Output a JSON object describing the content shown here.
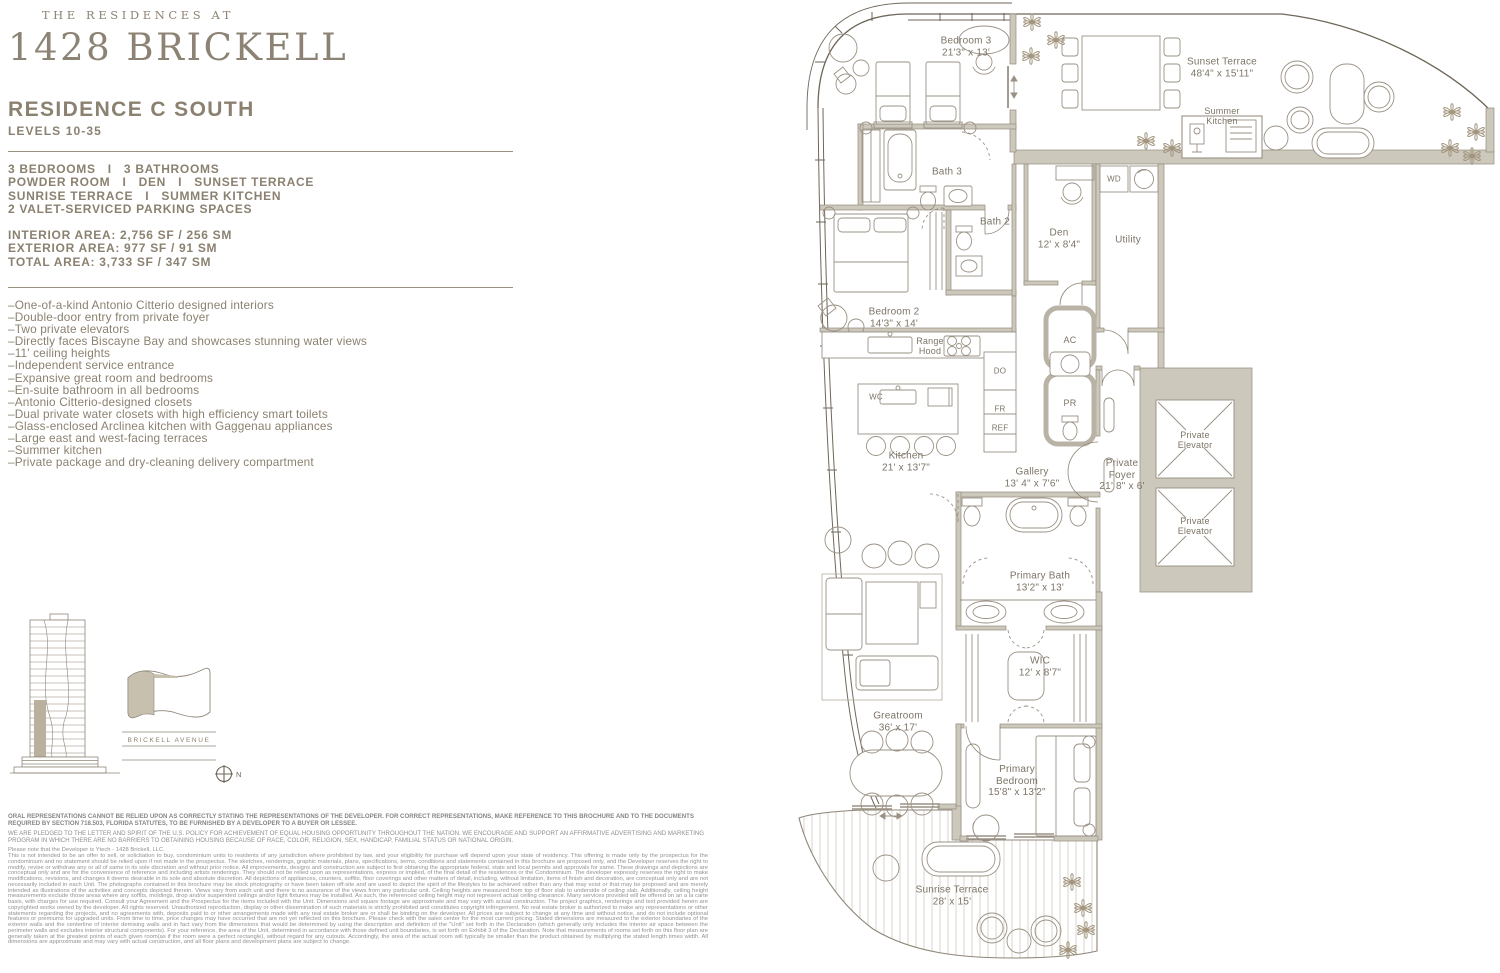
{
  "brand": {
    "eyebrow": "THE RESIDENCES AT",
    "name": "1428 BRICKELL"
  },
  "residence": {
    "title": "RESIDENCE C SOUTH",
    "levels": "LEVELS 10-35",
    "features": [
      "3 BEDROOMS   I   3 BATHROOMS",
      "POWDER ROOM   I   DEN   I   SUNSET TERRACE",
      "SUNRISE TERRACE   I   SUMMER KITCHEN",
      "2 VALET-SERVICED PARKING SPACES"
    ],
    "areas": [
      "INTERIOR AREA: 2,756 SF / 256 SM",
      "EXTERIOR AREA: 977 SF / 91 SM",
      "TOTAL AREA: 3,733 SF / 347 SM"
    ],
    "bullets": [
      "–One-of-a-kind Antonio Citterio designed interiors",
      "–Double-door entry from private foyer",
      "–Two private elevators",
      "–Directly faces Biscayne Bay and showcases stunning water views",
      "–11' ceiling heights",
      "–Independent service entrance",
      "–Expansive great room and bedrooms",
      "–En-suite bathroom in all bedrooms",
      "–Antonio Citterio-designed closets",
      "–Dual private water closets with high efficiency smart toilets",
      "–Glass-enclosed Arclinea kitchen with Gaggenau appliances",
      "–Large east and west-facing terraces",
      "–Summer kitchen",
      "–Private package and dry-cleaning delivery compartment"
    ]
  },
  "keyplan": {
    "street": "BRICKELL AVENUE",
    "compass_n": "N"
  },
  "plan": {
    "rooms": {
      "bedroom3": {
        "l1": "Bedroom 3",
        "l2": "21'3\" x 13'"
      },
      "bath3": {
        "l1": "Bath 3"
      },
      "bath2": {
        "l1": "Bath 2"
      },
      "bedroom2": {
        "l1": "Bedroom 2",
        "l2": "14'3\" x 14'"
      },
      "den": {
        "l1": "Den",
        "l2": "12' x 8'4\""
      },
      "utility": {
        "l1": "Utility"
      },
      "wd": {
        "l1": "WD"
      },
      "ac": {
        "l1": "AC"
      },
      "pr": {
        "l1": "PR"
      },
      "range_hood": {
        "l1": "Range",
        "l2": "Hood"
      },
      "wc": {
        "l1": "WC"
      },
      "do": {
        "l1": "DO"
      },
      "fr": {
        "l1": "FR"
      },
      "ref": {
        "l1": "REF"
      },
      "kitchen": {
        "l1": "Kitchen",
        "l2": "21' x 13'7\""
      },
      "gallery": {
        "l1": "Gallery",
        "l2": "13' 4\" x 7'6\""
      },
      "private_foyer": {
        "l1": "Private",
        "l2": "Foyer",
        "l3": "21' 8\" x 6'"
      },
      "elevator": {
        "l1": "Private",
        "l2": "Elevator"
      },
      "primary_bath": {
        "l1": "Primary Bath",
        "l2": "13'2\" x 13'"
      },
      "wic": {
        "l1": "WIC",
        "l2": "12' x 8'7\""
      },
      "greatroom": {
        "l1": "Greatroom",
        "l2": "36' x 17'"
      },
      "primary_bedroom": {
        "l1": "Primary",
        "l2": "Bedroom",
        "l3": "15'8\" x 13'2\""
      },
      "sunset_terrace": {
        "l1": "Sunset Terrace",
        "l2": "48'4\" x 15'11\""
      },
      "summer_kitchen": {
        "l1": "Summer",
        "l2": "Kitchen"
      },
      "sunrise_terrace": {
        "l1": "Sunrise Terrace",
        "l2": "28' x 15'"
      }
    }
  },
  "legal": {
    "p1": "ORAL REPRESENTATIONS CANNOT BE RELIED UPON AS CORRECTLY STATING THE REPRESENTATIONS OF THE DEVELOPER. FOR CORRECT REPRESENTATIONS, MAKE REFERENCE TO THIS BROCHURE AND TO THE DOCUMENTS REQUIRED BY SECTION 718.503, FLORIDA STATUTES, TO BE FURNISHED BY A DEVELOPER TO A BUYER OR LESSEE.",
    "p2": "WE ARE PLEDGED TO THE LETTER AND SPIRIT OF THE U.S. POLICY FOR ACHIEVEMENT OF EQUAL HOUSING OPPORTUNITY THROUGHOUT THE NATION. WE ENCOURAGE AND SUPPORT AN AFFIRMATIVE ADVERTISING AND MARKETING PROGRAM IN WHICH THERE ARE NO BARRIERS TO OBTAINING HOUSING BECAUSE OF RACE, COLOR, RELIGION, SEX, HANDICAP, FAMILIAL STATUS OR NATIONAL ORIGIN.",
    "developer_note": "Please note that the Developer is Ytech - 1428 Brickell, LLC.",
    "body": "This is not intended to be an offer to sell, or solicitation to buy, condominium units to residents of any jurisdiction where prohibited by law, and your eligibility for purchase will depend upon your state of residency. This offering is made only by the prospectus for the condominium and no statement should be relied upon if not made in the prospectus. The sketches, renderings, graphic materials, plans, specifications, terms, conditions and statements contained in this brochure are proposed only, and the Developer reserves the right to modify, revise or withdraw any or all of same in its sole discretion and without prior notice. All improvements, designs and construction are subject to first obtaining the appropriate federal, state and local permits and approvals for same. These drawings and depictions are conceptual only and are for the convenience of reference and including artists renderings. They should not be relied upon as representations, express or implied, of the final detail of the residences or the Condominium. The developer expressly reserves the right to make modifications, revisions, and changes it deems desirable in its sole and absolute discretion. All depictions of appliances, counters, soffits, floor coverings and other matters of detail, including, without limitation, items of finish and decoration, are conceptual only and are not necessarily included in each Unit. The photographs contained in this brochure may be stock photography or have been taken off-site and are used to depict the spirit of the lifestyles to be achieved rather than any that may exist or that may be proposed and are merely intended as illustrations of the activities and concepts depicted therein. Views vary from each unit and there is no assurance of the views from any particular unit. Ceiling heights are measured from top of floor slab to underside of ceiling slab. Additionally, ceiling height measurements exclude those areas where any soffits, moldings, drop and/or suspended ceilings and/or light fixtures may be installed. As such, the referenced ceiling height may not represent actual ceiling clearance. Many services provided will be offered on an a la carte basis, with charges for use required. Consult your Agreement and the Prospectus for the items included with the Unit. Dimensions and square footage are approximate and may vary with actual construction. The project graphics, renderings and text provided herein are copyrighted works owned by the developer. All rights reserved. Unauthorized reproduction, display or other dissemination of such materials is strictly prohibited and constitutes copyright infringement. No real estate broker is authorized to make any representations or other statements regarding the projects, and no agreements with, deposits paid to or other arrangements made with any real estate broker are or shall be binding on the developer. All prices are subject to change at any time and without notice, and do not include optional features or premiums for upgraded units. From time to time, price changes may have occurred that are not yet reflected on this brochure. Please check with the sales center for the most current pricing. Stated dimensions are measured to the exterior boundaries of the exterior walls and the centerline of interior demising walls and in fact vary from the dimensions that would be determined by using the description and definition of the \"Unit\" set forth in the Declaration (which generally only includes the interior air space between the perimeter walls and excludes interior structural components). For your reference, the area of the Unit, determined in accordance with those defined unit boundaries, is set forth on Exhibit 3 of the Declaration. Note that measurements of rooms set forth on this floor plan are generally taken at the greatest points of each given room(as if the room were a perfect rectangle), without regard for any cutouts. Accordingly, the area of the actual room will typically be smaller than the product obtained by multiplying the stated length times width. All dimensions are approximate and may vary with actual construction, and all floor plans and development plans are subject to change."
  },
  "colors": {
    "accent_text": "#8b8170",
    "wall_fill": "#cdc8bc",
    "plan_line": "#8f8678"
  }
}
